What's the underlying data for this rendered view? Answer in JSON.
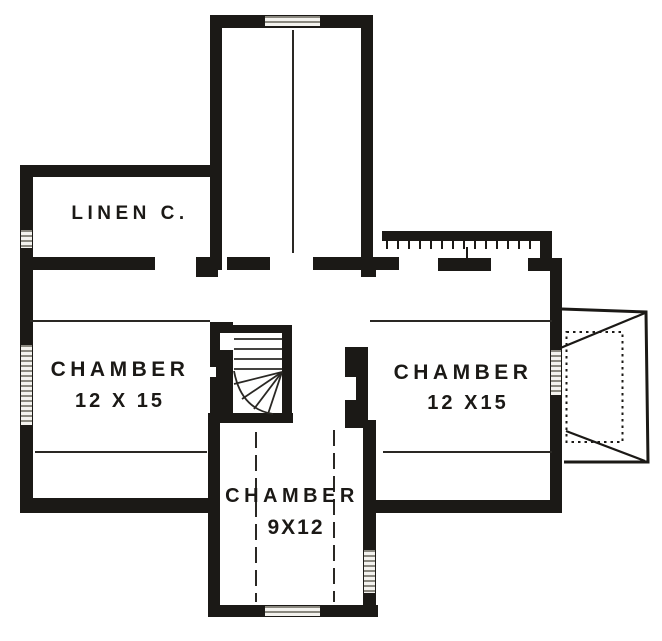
{
  "plan": {
    "kind": "floor-plan-drawing"
  },
  "labels": {
    "linen_closet": "LINEN C.",
    "chamber_left_name": "CHAMBER",
    "chamber_left_size": "12 X 15",
    "chamber_right_name": "CHAMBER",
    "chamber_right_size": "12 X15",
    "chamber_bottom_name": "CHAMBER",
    "chamber_bottom_size": "9X12"
  },
  "drawings": {
    "stairs": "winder-staircase-drawing",
    "bay_roof": "bay-window-hip-roof-drawing",
    "railing": "ticked-railing",
    "windows": "window-hatch-symbol"
  },
  "colors": {
    "ink": "#1b1916",
    "paper": "#ffffff",
    "hatch": "#8a887f"
  }
}
